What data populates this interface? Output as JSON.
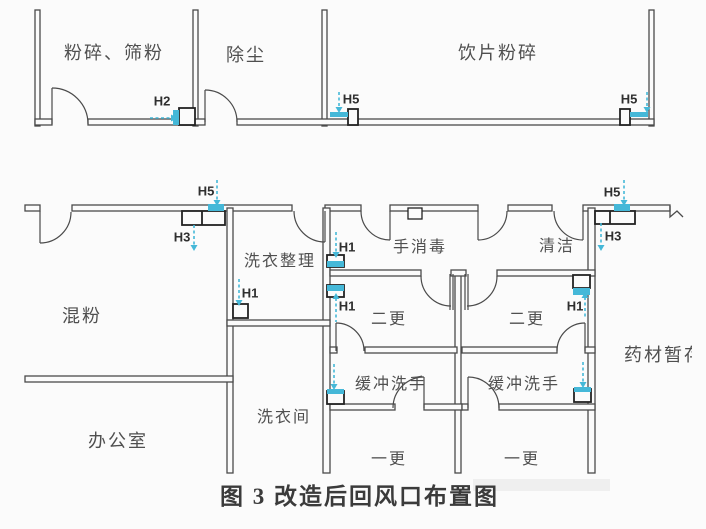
{
  "figure_caption": "图 3 改造后回风口布置图",
  "rooms": {
    "crushing_sieving": "粉碎、筛粉",
    "dust_removal": "除尘",
    "decoction_piece_crushing": "饮片粉碎",
    "powder_mixing": "混粉",
    "laundry_sorting": "洗衣整理",
    "hand_disinfection": "手消毒",
    "cleaning": "清洁",
    "second_change_left": "二更",
    "second_change_right": "二更",
    "buffer_handwash_left": "缓冲洗手",
    "buffer_handwash_right": "缓冲洗手",
    "first_change_left": "一更",
    "first_change_right": "一更",
    "laundry_room": "洗衣间",
    "office": "办公室",
    "herb_storage": "药材暂存"
  },
  "vent_labels": {
    "h2_top": "H2",
    "h5_top_left": "H5",
    "h5_top_right": "H5",
    "h5_mid_left": "H5",
    "h3_mid_left": "H3",
    "h5_mid_right": "H5",
    "h3_mid_right": "H3",
    "h1_laundry_sorting": "H1",
    "h1_hand_disinfection": "H1",
    "h1_second_change_left": "H1",
    "h1_second_change_right": "H1"
  },
  "colors": {
    "wall_line": "#4a4a4a",
    "vent_blue": "#45b8d8",
    "label_text": "#4f4f4f",
    "caption_text": "#3b3b3b"
  }
}
